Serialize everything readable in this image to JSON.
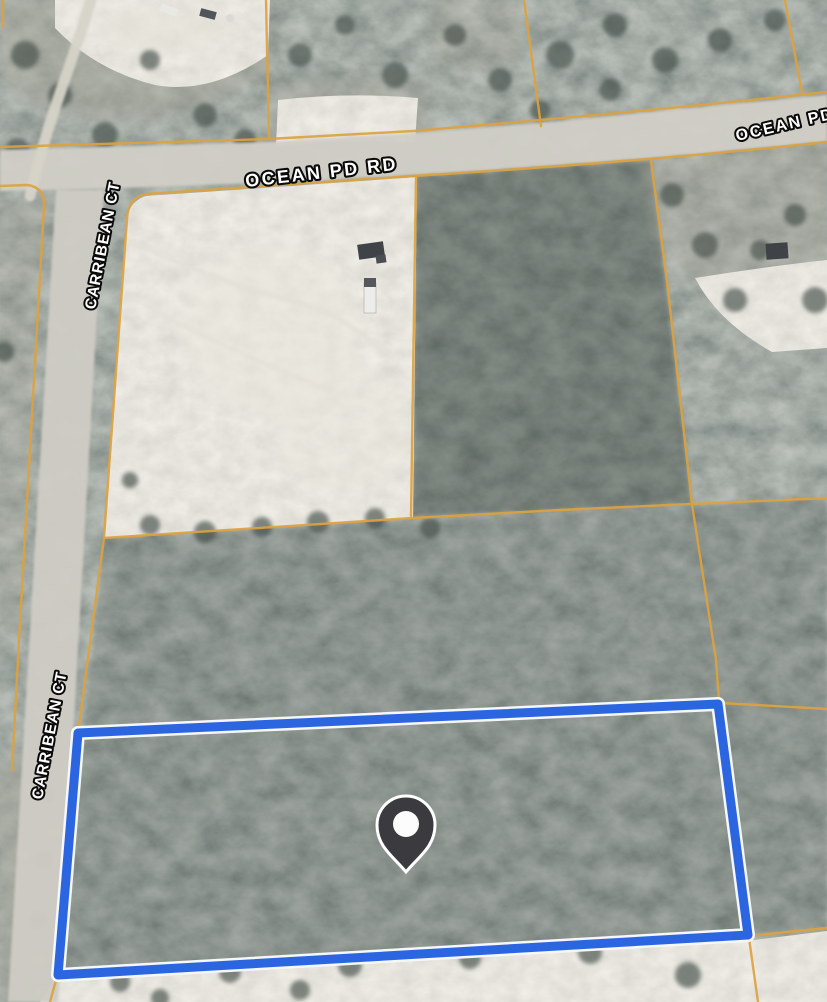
{
  "map": {
    "view": "satellite",
    "road_labels": {
      "ocean_pd_rd": "OCEAN PD RD",
      "ocean_pd_rd_right": "OCEAN PD",
      "carribean_ct_upper": "CARRIBEAN CT",
      "carribean_ct_lower": "CARRIBEAN CT"
    },
    "colors": {
      "parcel_line": "#dda23f",
      "selected_parcel": "#2b66e0",
      "selected_parcel_casing": "#f5f7f9",
      "pin_body": "#3b3b3f",
      "pin_outline": "#ffffff",
      "pin_dot": "#fcfcfc",
      "forest": "#57635d",
      "sand": "#dedbd2",
      "road": "#cfcdc5"
    }
  }
}
